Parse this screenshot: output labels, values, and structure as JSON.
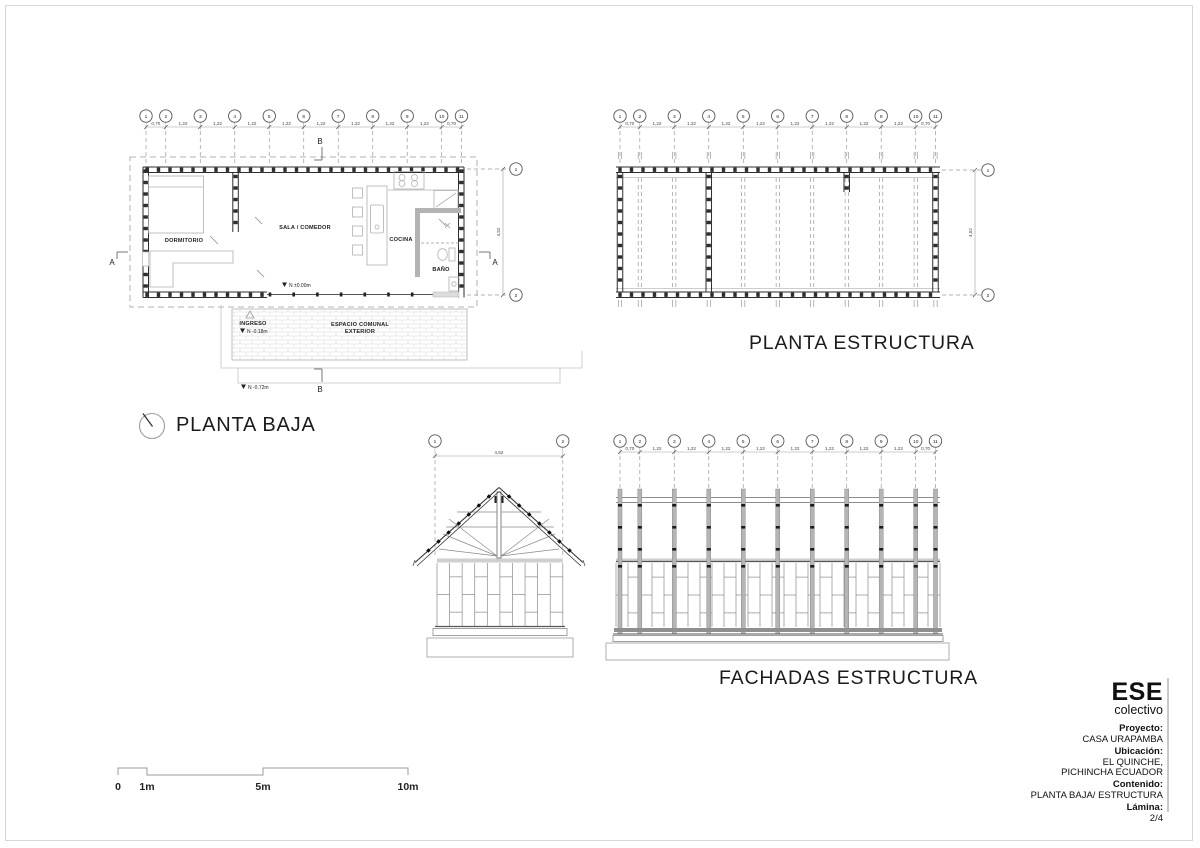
{
  "titles": {
    "planta_baja": "PLANTA BAJA",
    "planta_estructura": "PLANTA ESTRUCTURA",
    "fachadas_estructura": "FACHADAS ESTRUCTURA"
  },
  "grid": {
    "labels": [
      "1",
      "2",
      "3",
      "4",
      "5",
      "6",
      "7",
      "8",
      "9",
      "10",
      "11"
    ],
    "dims": [
      "0,70",
      "1,22",
      "1,22",
      "1,22",
      "1,22",
      "1,22",
      "1,22",
      "1,22",
      "1,22",
      "0,70"
    ],
    "row_labels": [
      "1",
      "2"
    ],
    "row_dim": "4,52"
  },
  "plan": {
    "rooms": {
      "dormitorio": "DORMITORIO",
      "sala": "SALA / COMEDOR",
      "cocina": "COCINA",
      "bano": "BAÑO",
      "ingreso": "INGRESO",
      "espacio": "ESPACIO COMUNAL",
      "exterior": "EXTERIOR"
    },
    "levels": {
      "interior": "N ±0.00m",
      "ingreso": "N -0.18m",
      "exterior": "N -0.72m"
    },
    "sections": {
      "a": "A",
      "b": "B"
    }
  },
  "titleblock": {
    "brand": "ESE",
    "brand_sub": "colectivo",
    "fields": [
      {
        "label": "Proyecto:",
        "lines": [
          "CASA URAPAMBA"
        ]
      },
      {
        "label": "Ubicación:",
        "lines": [
          "EL QUINCHE,",
          "PICHINCHA ECUADOR"
        ]
      },
      {
        "label": "Contenido:",
        "lines": [
          "PLANTA BAJA/ ESTRUCTURA"
        ]
      },
      {
        "label": "Lámina:",
        "lines": [
          "2/4"
        ]
      }
    ]
  },
  "scalebar": {
    "labels": [
      "0",
      "1m",
      "5m",
      "10m"
    ]
  },
  "colors": {
    "ink": "#2e2e2e",
    "mid": "#666666",
    "gray": "#9b9b9b",
    "light": "#c9c9c9",
    "post": "#b5b5b5",
    "text": "#1c1c1c"
  }
}
